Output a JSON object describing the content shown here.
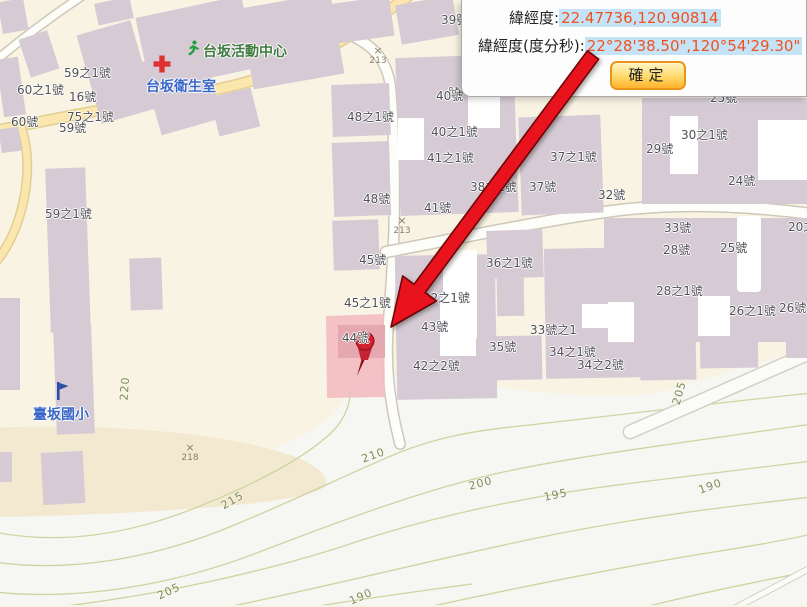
{
  "popup": {
    "coord_label": "緯經度:",
    "coord_value": "22.47736,120.90814",
    "dms_label": "緯經度(度分秒):",
    "dms_value": "22°28'38.50\",120°54'29.30\"",
    "confirm_button": "確定"
  },
  "map": {
    "highlighted_parcel_label": "44號",
    "pois": [
      {
        "name": "台坂活動中心",
        "icon": "running-person-icon",
        "x": 203,
        "y": 41,
        "icon_x": 185,
        "icon_y": 40,
        "text_color": "#3f7a3f"
      },
      {
        "name": "台坂衛生室",
        "icon": "first-aid-cross-icon",
        "x": 146,
        "y": 76,
        "icon_x": 153,
        "icon_y": 55,
        "text_color": "#3a66c8"
      },
      {
        "name": "臺坂國小",
        "icon": "school-flag-icon",
        "x": 33,
        "y": 404,
        "icon_x": 55,
        "icon_y": 381,
        "text_color": "#3a66c8"
      }
    ],
    "building_labels": [
      {
        "text": "59之1號",
        "x": 64,
        "y": 67
      },
      {
        "text": "60之1號",
        "x": 17,
        "y": 84
      },
      {
        "text": "16號",
        "x": 69,
        "y": 91
      },
      {
        "text": "60號",
        "x": 11,
        "y": 116
      },
      {
        "text": "75之1號",
        "x": 67,
        "y": 111
      },
      {
        "text": "59號",
        "x": 59,
        "y": 122
      },
      {
        "text": "59之1號",
        "x": 45,
        "y": 208
      },
      {
        "text": "48之1號",
        "x": 347,
        "y": 111
      },
      {
        "text": "48號",
        "x": 363,
        "y": 193
      },
      {
        "text": "45號",
        "x": 359,
        "y": 254
      },
      {
        "text": "45之1號",
        "x": 344,
        "y": 297
      },
      {
        "text": "44號",
        "x": 342,
        "y": 332
      },
      {
        "text": "39號",
        "x": 441,
        "y": 14
      },
      {
        "text": "號",
        "x": 448,
        "y": 87
      },
      {
        "text": "40號",
        "x": 436,
        "y": 90
      },
      {
        "text": "40之1號",
        "x": 431,
        "y": 126
      },
      {
        "text": "41之1號",
        "x": 427,
        "y": 152
      },
      {
        "text": "41號",
        "x": 424,
        "y": 202
      },
      {
        "text": "42之1號",
        "x": 423,
        "y": 292
      },
      {
        "text": "43號",
        "x": 421,
        "y": 321
      },
      {
        "text": "42之2號",
        "x": 413,
        "y": 360
      },
      {
        "text": "36之1號",
        "x": 486,
        "y": 257
      },
      {
        "text": "35號",
        "x": 489,
        "y": 341
      },
      {
        "text": "33號之1",
        "x": 530,
        "y": 324
      },
      {
        "text": "34之1號",
        "x": 549,
        "y": 346
      },
      {
        "text": "34之2號",
        "x": 577,
        "y": 359
      },
      {
        "text": "38之1號",
        "x": 470,
        "y": 181
      },
      {
        "text": "37號",
        "x": 529,
        "y": 181
      },
      {
        "text": "37之1號",
        "x": 550,
        "y": 151
      },
      {
        "text": "32號",
        "x": 598,
        "y": 189
      },
      {
        "text": "33號",
        "x": 664,
        "y": 222
      },
      {
        "text": "28號",
        "x": 663,
        "y": 244
      },
      {
        "text": "25號",
        "x": 720,
        "y": 242
      },
      {
        "text": "28之1號",
        "x": 656,
        "y": 285
      },
      {
        "text": "26之1號",
        "x": 729,
        "y": 305
      },
      {
        "text": "26號",
        "x": 779,
        "y": 302
      },
      {
        "text": "24號",
        "x": 728,
        "y": 175
      },
      {
        "text": "30之1號",
        "x": 681,
        "y": 129
      },
      {
        "text": "29號",
        "x": 646,
        "y": 143
      },
      {
        "text": "25號",
        "x": 710,
        "y": 92
      },
      {
        "text": "20之1號",
        "x": 788,
        "y": 221
      }
    ],
    "elevation_markers": [
      {
        "value": "213",
        "x": 378,
        "y": 45
      },
      {
        "value": "213",
        "x": 402,
        "y": 215
      },
      {
        "value": "218",
        "x": 190,
        "y": 442
      }
    ],
    "contour_labels": [
      {
        "text": "220",
        "x": 124,
        "y": 394,
        "rot": -86
      },
      {
        "text": "215",
        "x": 222,
        "y": 500,
        "rot": -30
      },
      {
        "text": "210",
        "x": 362,
        "y": 453,
        "rot": -20
      },
      {
        "text": "205",
        "x": 158,
        "y": 590,
        "rot": -25
      },
      {
        "text": "200",
        "x": 469,
        "y": 480,
        "rot": -15
      },
      {
        "text": "195",
        "x": 544,
        "y": 491,
        "rot": -12
      },
      {
        "text": "190",
        "x": 699,
        "y": 484,
        "rot": -20
      },
      {
        "text": "190",
        "x": 350,
        "y": 595,
        "rot": -24
      },
      {
        "text": "205",
        "x": 676,
        "y": 398,
        "rot": -74
      }
    ]
  },
  "colors": {
    "arrow": "#e8131c",
    "highlight_fill": "#f3bcc1",
    "value_text": "#f1511f",
    "value_highlight_bg": "#c5e3f7",
    "button_border": "#e8951e",
    "building_fill": "#d6cbd5",
    "road_yellow": "#fbe7ae",
    "contour_line": "#ccd5a0"
  }
}
